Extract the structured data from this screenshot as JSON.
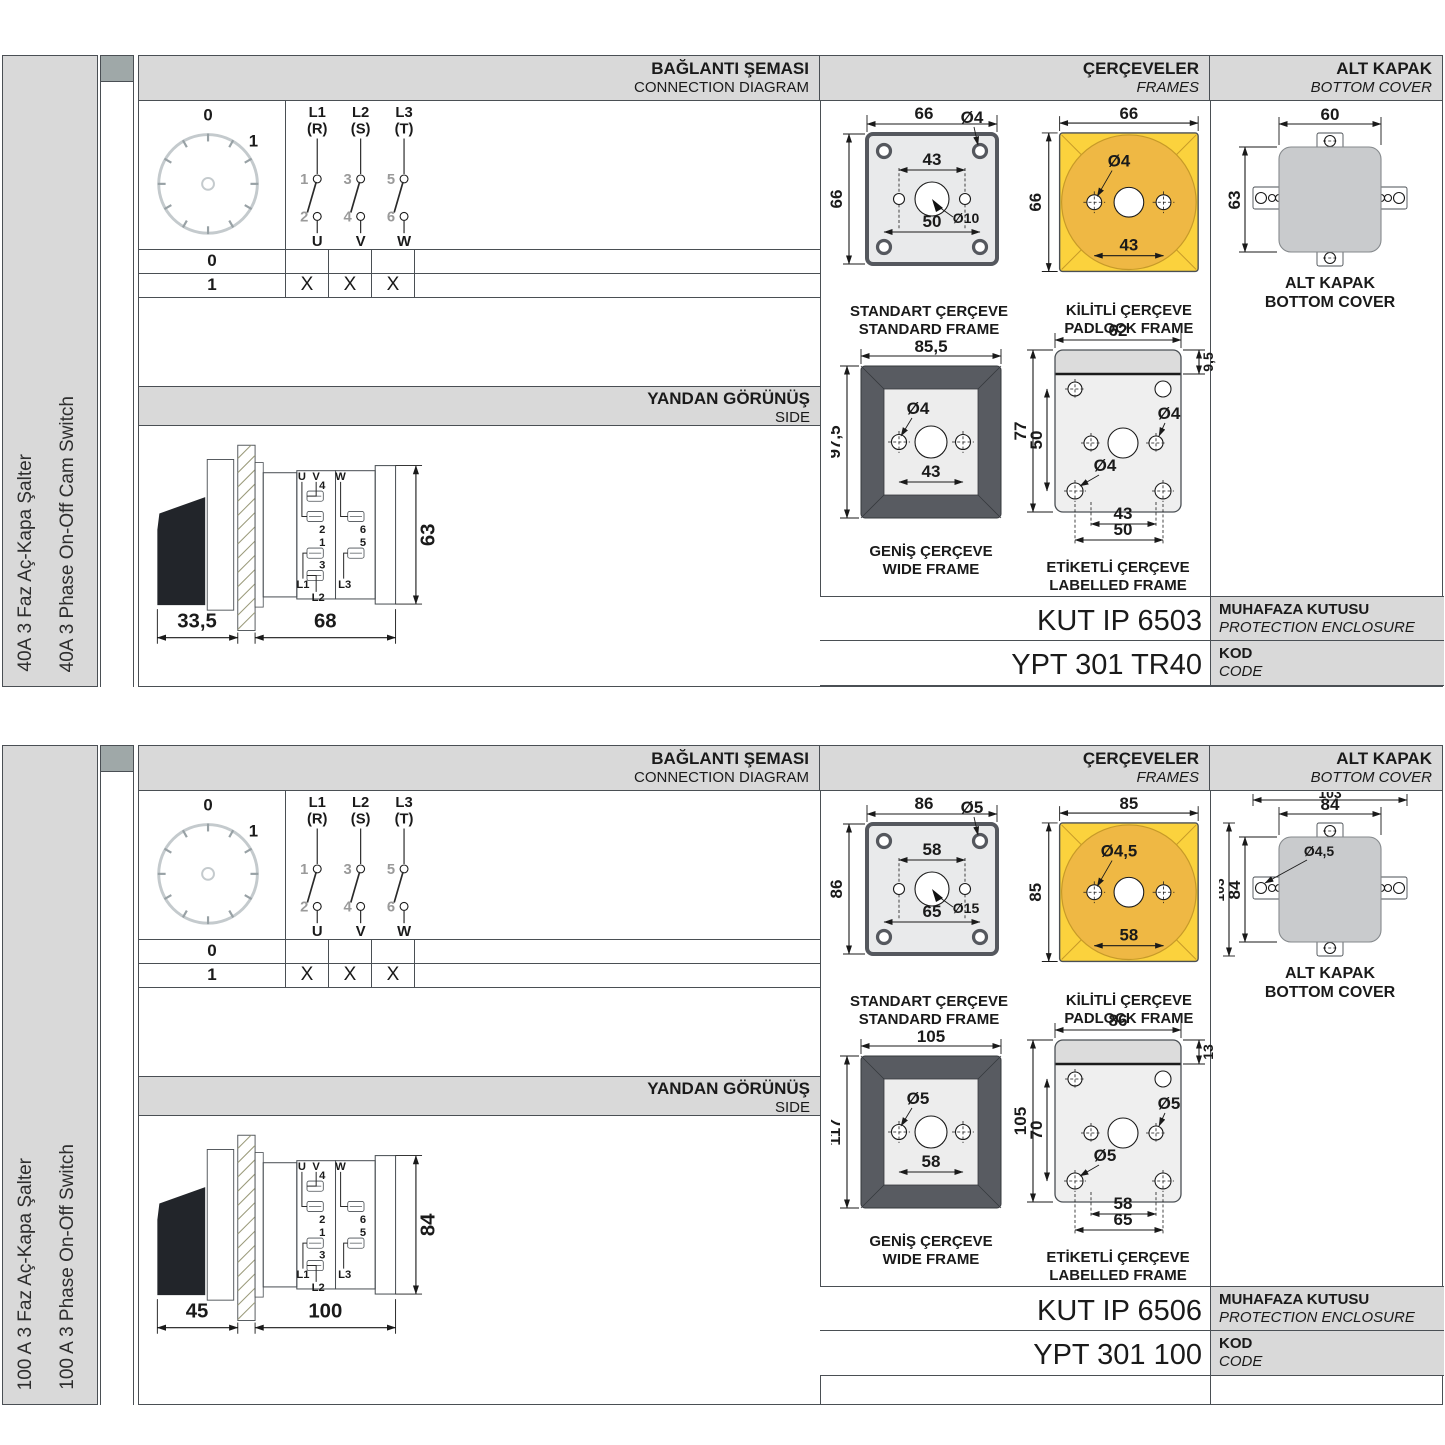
{
  "common": {
    "headers": {
      "connection_tr": "BAĞLANTI ŞEMASI",
      "connection_en": "CONNECTION DIAGRAM",
      "frames_tr": "ÇERÇEVELER",
      "frames_en": "FRAMES",
      "cover_tr": "ALT KAPAK",
      "cover_en": "BOTTOM COVER",
      "side_tr": "YANDAN GÖRÜNÜŞ",
      "side_en": "SIDE"
    },
    "connection": {
      "dial_positions": [
        "0",
        "1"
      ],
      "phases": [
        {
          "line": "L1",
          "phase": "(R)",
          "in": "1",
          "out": "2",
          "load": "U"
        },
        {
          "line": "L2",
          "phase": "(S)",
          "in": "3",
          "out": "4",
          "load": "V"
        },
        {
          "line": "L3",
          "phase": "(T)",
          "in": "5",
          "out": "6",
          "load": "W"
        }
      ],
      "table": [
        {
          "position": "0",
          "marks": [
            "",
            "",
            ""
          ]
        },
        {
          "position": "1",
          "marks": [
            "X",
            "X",
            "X"
          ]
        }
      ]
    },
    "frame_labels": {
      "standard_tr": "STANDART ÇERÇEVE",
      "standard_en": "STANDARD FRAME",
      "padlock_tr": "KİLİTLİ ÇERÇEVE",
      "padlock_en": "PADLOCK FRAME",
      "wide_tr": "GENİŞ ÇERÇEVE",
      "wide_en": "WIDE FRAME",
      "labelled_tr": "ETİKETLİ ÇERÇEVE",
      "labelled_en": "LABELLED FRAME",
      "cover_tr": "ALT KAPAK",
      "cover_en": "BOTTOM COVER"
    },
    "code_labels": {
      "enclosure_tr": "MUHAFAZA KUTUSU",
      "enclosure_en": "PROTECTION ENCLOSURE",
      "code_tr": "KOD",
      "code_en": "CODE"
    },
    "side_terminals": {
      "u": "U",
      "v": "V",
      "w": "W",
      "t4": "4",
      "t2": "2",
      "t1": "1",
      "t3": "3",
      "t6": "6",
      "t5": "5",
      "l1": "L1",
      "l2": "L2",
      "l3": "L3"
    },
    "colors": {
      "accent_yellow": "#FBD23D",
      "accent_amber": "#EFB844",
      "panel_gray": "#D9D9D9",
      "frame_dark": "#55585E"
    }
  },
  "panels": [
    {
      "product_tr": "40A 3 Faz Aç-Kapa Şalter",
      "product_en": "40A 3 Phase On-Off Cam Switch",
      "side_view": {
        "depth": "33,5",
        "length": "68",
        "height": "63"
      },
      "frames": {
        "standard": {
          "width": "66",
          "height": "66",
          "hole": "Ø4",
          "span_top": "43",
          "center_hole": "Ø10",
          "span_bottom": "50"
        },
        "padlock": {
          "width": "66",
          "height": "66",
          "hole": "Ø4",
          "span": "43"
        },
        "wide": {
          "width": "85,5",
          "height": "97,5",
          "hole": "Ø4",
          "span": "43"
        },
        "labelled": {
          "width": "62",
          "strip": "9,5",
          "height": "77",
          "inner_height": "50",
          "hole_upper": "Ø4",
          "hole_lower": "Ø4",
          "span_inner": "43",
          "span_outer": "50"
        }
      },
      "cover": {
        "width": "60",
        "height": "63",
        "width_total": "",
        "height_total": "",
        "hole": ""
      },
      "codes": {
        "enclosure": "KUT IP 6503",
        "code": "YPT 301 TR40"
      }
    },
    {
      "product_tr": "100 A 3 Faz Aç-Kapa Şalter",
      "product_en": "100 A 3 Phase On-Off Switch",
      "side_view": {
        "depth": "45",
        "length": "100",
        "height": "84"
      },
      "frames": {
        "standard": {
          "width": "86",
          "height": "86",
          "hole": "Ø5",
          "span_top": "58",
          "center_hole": "Ø15",
          "span_bottom": "65"
        },
        "padlock": {
          "width": "85",
          "height": "85",
          "hole": "Ø4,5",
          "span": "58"
        },
        "wide": {
          "width": "105",
          "height": "117",
          "hole": "Ø5",
          "span": "58"
        },
        "labelled": {
          "width": "86",
          "strip": "13",
          "height": "105",
          "inner_height": "70",
          "hole_upper": "Ø5",
          "hole_lower": "Ø5",
          "span_inner": "58",
          "span_outer": "65"
        }
      },
      "cover": {
        "width": "84",
        "height": "84",
        "width_total": "103",
        "height_total": "103",
        "hole": "Ø4,5"
      },
      "codes": {
        "enclosure": "KUT IP 6506",
        "code": "YPT 301 100"
      }
    }
  ]
}
